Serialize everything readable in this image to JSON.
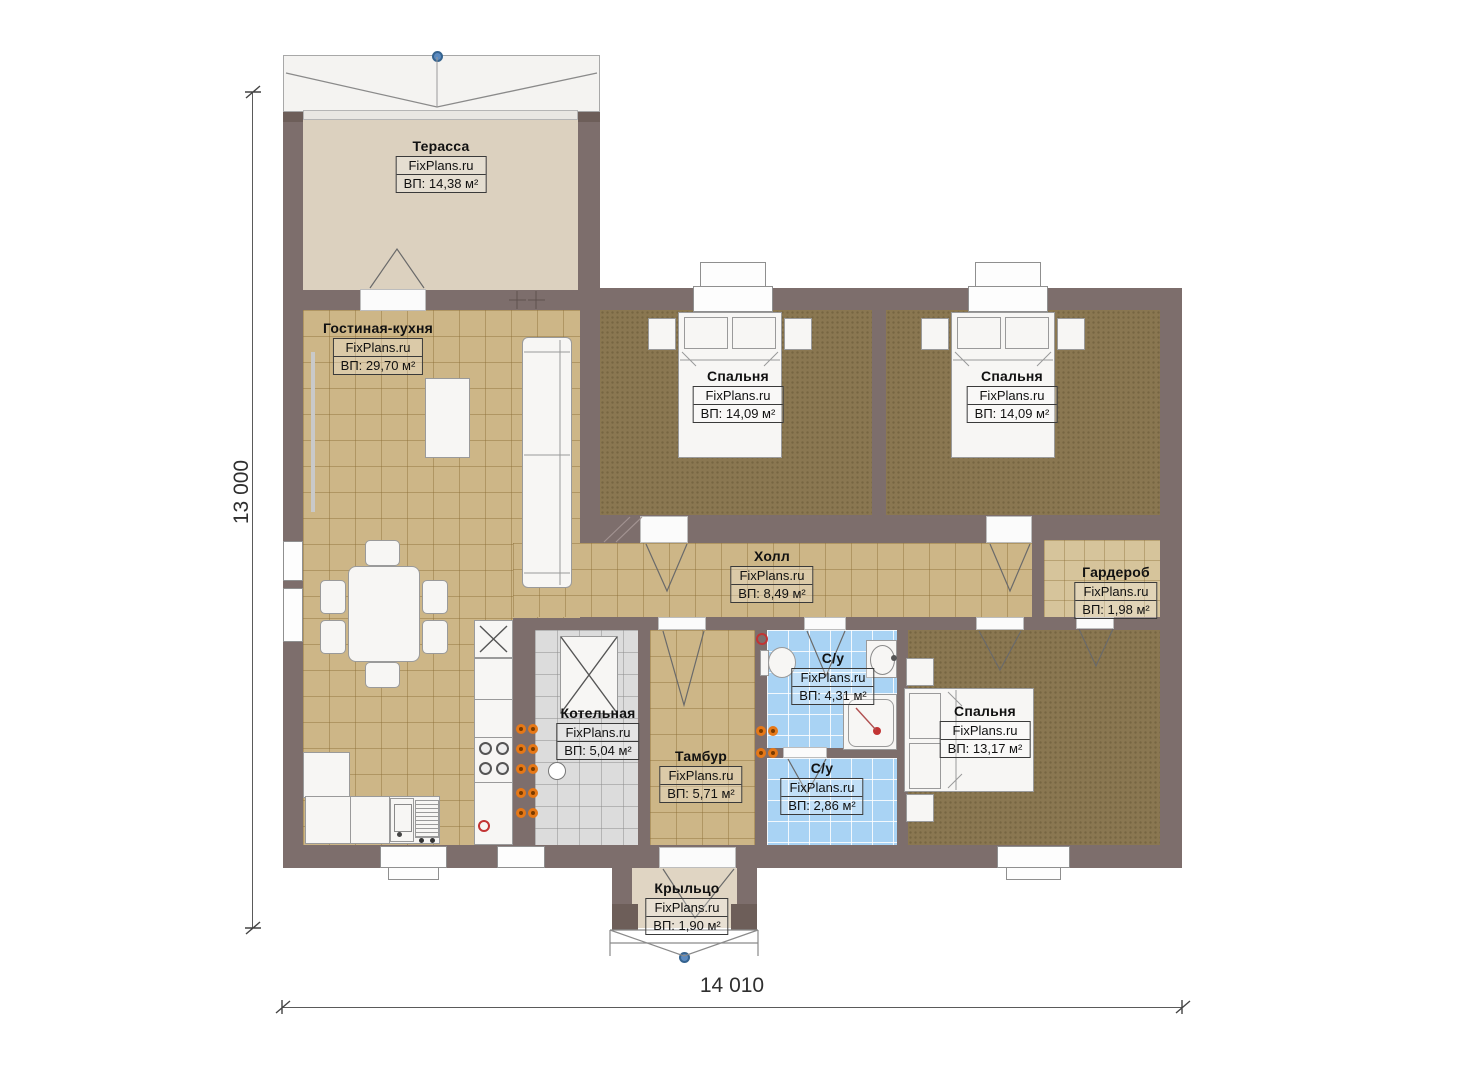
{
  "watermark": "FixPlans.ru",
  "dimensions": {
    "height_label": "13 000",
    "width_label": "14 010"
  },
  "rooms": {
    "terrace": {
      "name": "Терасса",
      "area": "ВП: 14,38 м²"
    },
    "living": {
      "name": "Гостиная-кухня",
      "area": "ВП: 29,70 м²"
    },
    "bedroom1": {
      "name": "Спальня",
      "area": "ВП: 14,09 м²"
    },
    "bedroom2": {
      "name": "Спальня",
      "area": "ВП: 14,09 м²"
    },
    "hall": {
      "name": "Холл",
      "area": "ВП: 8,49 м²"
    },
    "wardrobe": {
      "name": "Гардероб",
      "area": "ВП: 1,98 м²"
    },
    "boiler": {
      "name": "Котельная",
      "area": "ВП: 5,04 м²"
    },
    "vestibule": {
      "name": "Тамбур",
      "area": "ВП: 5,71 м²"
    },
    "bath1": {
      "name": "С/у",
      "area": "ВП: 4,31 м²"
    },
    "bath2": {
      "name": "С/у",
      "area": "ВП: 2,86 м²"
    },
    "bedroom3": {
      "name": "Спальня",
      "area": "ВП: 13,17 м²"
    },
    "porch": {
      "name": "Крыльцо",
      "area": "ВП: 1,90 м²"
    }
  },
  "colors": {
    "wall": "#7d6e6c",
    "wall_dark": "#6d5e59",
    "floor_tile": "#cdb687",
    "carpet": "#8a7751",
    "bath_tile": "#a9d3f4",
    "boiler_tile": "#dcdcdc",
    "terrace_floor": "#dcd1bf",
    "socket_orange": "#e67817",
    "marker_blue": "#5b8ac0",
    "marker_red": "#c23434"
  }
}
